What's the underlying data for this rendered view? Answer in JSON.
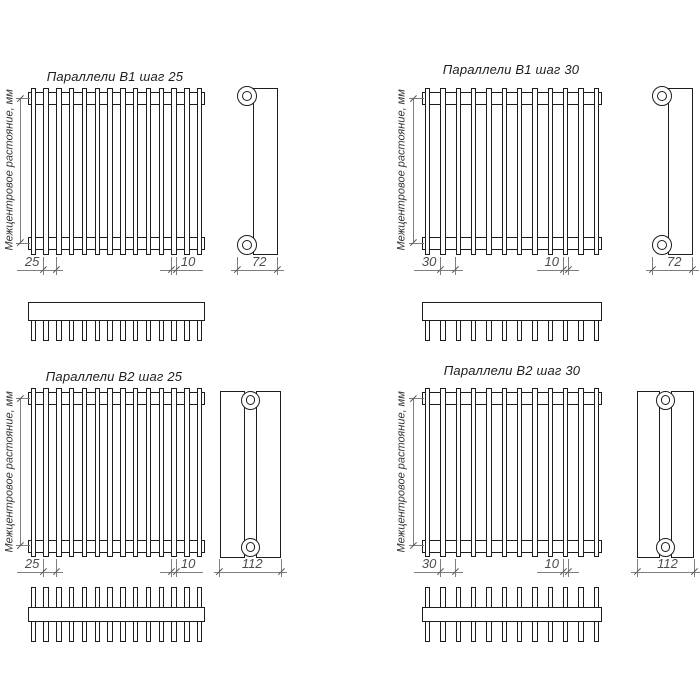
{
  "drawing": {
    "product": "Параллели",
    "background": "#ffffff",
    "line_color": "#1d1d1d",
    "thin_line_color": "#7e7e7e",
    "dim_text_color": "#4c4c4c"
  },
  "quadrants": [
    {
      "id": "b1-step-25",
      "title": "Параллели В1 шаг 25",
      "vertical_axis_label": "Межцентровое растояние, мм",
      "dimensions": {
        "pitch": "25",
        "tube_width": "10",
        "depth": "72"
      },
      "tube_count": 14,
      "tube_rows": 1
    },
    {
      "id": "b1-step-30",
      "title": "Параллели В1 шаг 30",
      "vertical_axis_label": "Межцентровое растояние, мм",
      "dimensions": {
        "pitch": "30",
        "tube_width": "10",
        "depth": "72"
      },
      "tube_count": 12,
      "tube_rows": 1
    },
    {
      "id": "b2-step-25",
      "title": "Параллели В2 шаг 25",
      "vertical_axis_label": "Межцентровое растояние, мм",
      "dimensions": {
        "pitch": "25",
        "tube_width": "10",
        "depth": "112"
      },
      "tube_count": 14,
      "tube_rows": 2
    },
    {
      "id": "b2-step-30",
      "title": "Параллели В2 шаг 30",
      "vertical_axis_label": "Межцентровое растояние, мм",
      "dimensions": {
        "pitch": "30",
        "tube_width": "10",
        "depth": "112"
      },
      "tube_count": 12,
      "tube_rows": 2
    }
  ]
}
